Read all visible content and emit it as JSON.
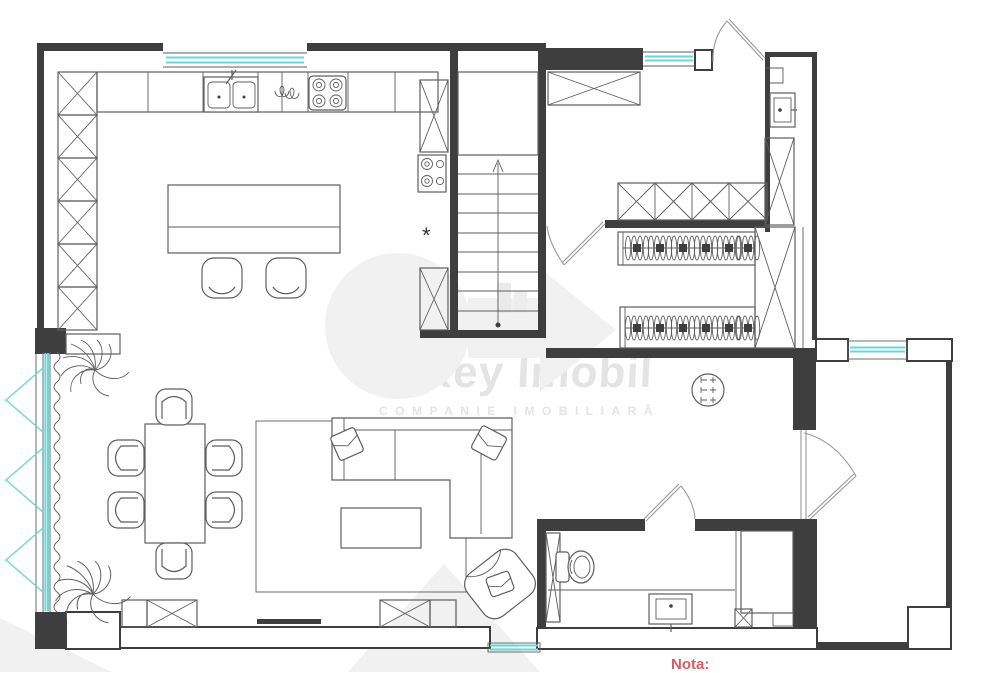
{
  "watermark": {
    "title": "O’Key Imobil",
    "subtitle": "COMPANIE IMOBILIARĂ"
  },
  "note": {
    "label": "Nota:"
  },
  "colors": {
    "wall": "#3e3e3e",
    "line": "#5e5e5e",
    "accent_window": "#66d8db",
    "watermark_text": "#e4e4e4",
    "watermark_shape": "#f1f1f1",
    "note_red": "#d95b64"
  },
  "plan": {
    "asterisk": "*",
    "fixtures": [
      "window",
      "entrance-door",
      "interior-door",
      "staircase-up",
      "kitchen-counter",
      "kitchen-sink",
      "hob",
      "oven-hob",
      "kitchen-island",
      "bar-stool",
      "tall-cabinet",
      "wardrobe-shelves",
      "clothes-rail",
      "dining-table",
      "dining-chair",
      "plant",
      "sofa",
      "armchair",
      "coffee-table",
      "rug",
      "tv",
      "round-table",
      "toilet",
      "shower",
      "vanity-sink",
      "towel-radiator",
      "structural-column",
      "curtain"
    ]
  }
}
